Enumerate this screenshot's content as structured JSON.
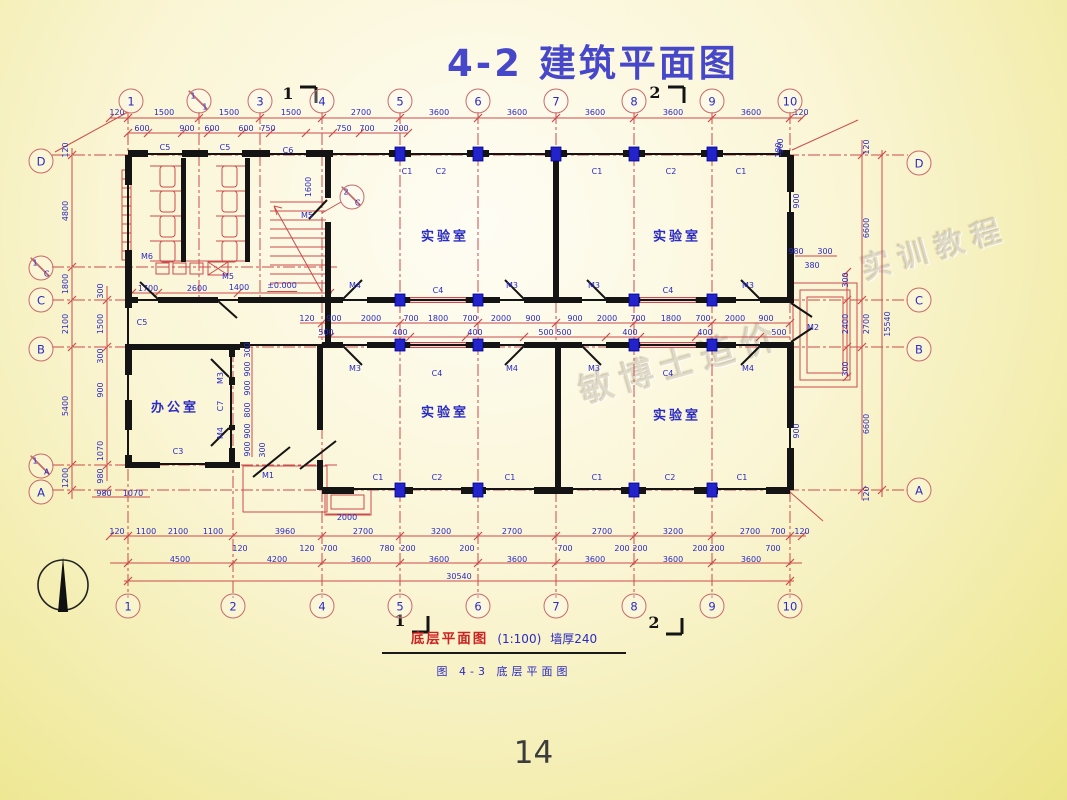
{
  "page": {
    "title": "4-2  建筑平面图",
    "page_number": "14"
  },
  "caption": {
    "name": "底层平面图",
    "scale": "(1:100)",
    "wall_note": "墙厚240",
    "figure": "图 4-3  底层平面图"
  },
  "watermark": {
    "text1": "敏博士造价",
    "text2": "实训教程"
  },
  "colors": {
    "title_blue": "#4747ca",
    "dim_blue": "#2a2ac4",
    "line_red": "#cc4b4b",
    "wall_black": "#141414",
    "column_blue": "#2323cc",
    "caption_red": "#cc2222"
  },
  "plan": {
    "rooms_note": "four labs and one office",
    "bubbles": [
      {
        "t": "1",
        "x": 131,
        "y": 101
      },
      {
        "t": "1/1",
        "x": 199,
        "y": 101
      },
      {
        "t": "3",
        "x": 260,
        "y": 101
      },
      {
        "t": "4",
        "x": 322,
        "y": 101
      },
      {
        "t": "5",
        "x": 400,
        "y": 101
      },
      {
        "t": "6",
        "x": 478,
        "y": 101
      },
      {
        "t": "7",
        "x": 556,
        "y": 101
      },
      {
        "t": "8",
        "x": 634,
        "y": 101
      },
      {
        "t": "9",
        "x": 712,
        "y": 101
      },
      {
        "t": "10",
        "x": 790,
        "y": 101
      },
      {
        "t": "1",
        "x": 128,
        "y": 606
      },
      {
        "t": "2",
        "x": 233,
        "y": 606
      },
      {
        "t": "4",
        "x": 322,
        "y": 606
      },
      {
        "t": "5",
        "x": 400,
        "y": 606
      },
      {
        "t": "6",
        "x": 478,
        "y": 606
      },
      {
        "t": "7",
        "x": 556,
        "y": 606
      },
      {
        "t": "8",
        "x": 634,
        "y": 606
      },
      {
        "t": "9",
        "x": 712,
        "y": 606
      },
      {
        "t": "10",
        "x": 790,
        "y": 606
      },
      {
        "t": "D",
        "x": 41,
        "y": 161
      },
      {
        "t": "1/C",
        "x": 41,
        "y": 268
      },
      {
        "t": "C",
        "x": 41,
        "y": 300
      },
      {
        "t": "B",
        "x": 41,
        "y": 349
      },
      {
        "t": "1/A",
        "x": 41,
        "y": 466
      },
      {
        "t": "A",
        "x": 41,
        "y": 492
      },
      {
        "t": "D",
        "x": 919,
        "y": 163
      },
      {
        "t": "C",
        "x": 919,
        "y": 300
      },
      {
        "t": "B",
        "x": 919,
        "y": 349
      },
      {
        "t": "A",
        "x": 919,
        "y": 490
      },
      {
        "t": "2/C",
        "x": 352,
        "y": 197
      }
    ],
    "labels": [
      {
        "t": "120",
        "x": 117,
        "y": 113
      },
      {
        "t": "1500",
        "x": 164,
        "y": 113
      },
      {
        "t": "1500",
        "x": 229,
        "y": 113
      },
      {
        "t": "1500",
        "x": 291,
        "y": 113
      },
      {
        "t": "2700",
        "x": 361,
        "y": 113
      },
      {
        "t": "3600",
        "x": 439,
        "y": 113
      },
      {
        "t": "3600",
        "x": 517,
        "y": 113
      },
      {
        "t": "3600",
        "x": 595,
        "y": 113
      },
      {
        "t": "3600",
        "x": 673,
        "y": 113
      },
      {
        "t": "3600",
        "x": 751,
        "y": 113
      },
      {
        "t": "120",
        "x": 801,
        "y": 113
      },
      {
        "t": "600",
        "x": 142,
        "y": 129
      },
      {
        "t": "900",
        "x": 187,
        "y": 129
      },
      {
        "t": "600",
        "x": 212,
        "y": 129
      },
      {
        "t": "600",
        "x": 246,
        "y": 129
      },
      {
        "t": "750",
        "x": 268,
        "y": 129
      },
      {
        "t": "750",
        "x": 344,
        "y": 129
      },
      {
        "t": "700",
        "x": 367,
        "y": 129
      },
      {
        "t": "200",
        "x": 401,
        "y": 129
      },
      {
        "t": "900",
        "x": 781,
        "y": 146,
        "r": 1
      },
      {
        "t": "120",
        "x": 66,
        "y": 150,
        "r": 1
      },
      {
        "t": "4800",
        "x": 66,
        "y": 211,
        "r": 1
      },
      {
        "t": "1800",
        "x": 66,
        "y": 284,
        "r": 1
      },
      {
        "t": "2100",
        "x": 66,
        "y": 324,
        "r": 1
      },
      {
        "t": "5400",
        "x": 66,
        "y": 406,
        "r": 1
      },
      {
        "t": "1200",
        "x": 66,
        "y": 478,
        "r": 1
      },
      {
        "t": "300",
        "x": 101,
        "y": 291,
        "r": 1
      },
      {
        "t": "1500",
        "x": 101,
        "y": 324,
        "r": 1
      },
      {
        "t": "300",
        "x": 101,
        "y": 356,
        "r": 1
      },
      {
        "t": "900",
        "x": 101,
        "y": 390,
        "r": 1
      },
      {
        "t": "1070",
        "x": 101,
        "y": 451,
        "r": 1
      },
      {
        "t": "980",
        "x": 101,
        "y": 476,
        "r": 1
      },
      {
        "t": "980",
        "x": 104,
        "y": 494
      },
      {
        "t": "1070",
        "x": 133,
        "y": 494
      },
      {
        "t": "120",
        "x": 867,
        "y": 147,
        "r": 1
      },
      {
        "t": "6600",
        "x": 867,
        "y": 228,
        "r": 1
      },
      {
        "t": "2700",
        "x": 867,
        "y": 324,
        "r": 1
      },
      {
        "t": "6600",
        "x": 867,
        "y": 424,
        "r": 1
      },
      {
        "t": "120",
        "x": 867,
        "y": 494,
        "r": 1
      },
      {
        "t": "15540",
        "x": 888,
        "y": 324,
        "r": 1
      },
      {
        "t": "300",
        "x": 846,
        "y": 280,
        "r": 1
      },
      {
        "t": "2400",
        "x": 846,
        "y": 324,
        "r": 1
      },
      {
        "t": "300",
        "x": 846,
        "y": 369,
        "r": 1
      },
      {
        "t": "900",
        "x": 797,
        "y": 201,
        "r": 1
      },
      {
        "t": "980",
        "x": 796,
        "y": 252
      },
      {
        "t": "300",
        "x": 825,
        "y": 252
      },
      {
        "t": "380",
        "x": 812,
        "y": 266
      },
      {
        "t": "M2",
        "x": 813,
        "y": 328
      },
      {
        "t": "900",
        "x": 797,
        "y": 431,
        "r": 1
      },
      {
        "t": "180",
        "x": 779,
        "y": 150,
        "r": 1
      },
      {
        "t": "C5",
        "x": 165,
        "y": 148
      },
      {
        "t": "C5",
        "x": 225,
        "y": 148
      },
      {
        "t": "C6",
        "x": 288,
        "y": 151
      },
      {
        "t": "1600",
        "x": 309,
        "y": 187,
        "r": 1
      },
      {
        "t": "M5",
        "x": 307,
        "y": 216
      },
      {
        "t": "M5",
        "x": 228,
        "y": 277
      },
      {
        "t": "M6",
        "x": 147,
        "y": 257
      },
      {
        "t": "1700",
        "x": 148,
        "y": 289
      },
      {
        "t": "2600",
        "x": 197,
        "y": 289
      },
      {
        "t": "1400",
        "x": 239,
        "y": 288
      },
      {
        "t": "±0.000",
        "x": 282,
        "y": 287,
        "c": "level"
      },
      {
        "t": "C1",
        "x": 407,
        "y": 172
      },
      {
        "t": "C2",
        "x": 441,
        "y": 172
      },
      {
        "t": "C1",
        "x": 597,
        "y": 172
      },
      {
        "t": "C2",
        "x": 671,
        "y": 172
      },
      {
        "t": "C1",
        "x": 741,
        "y": 172
      },
      {
        "t": "C5",
        "x": 142,
        "y": 323
      },
      {
        "t": "M4",
        "x": 355,
        "y": 286
      },
      {
        "t": "C4",
        "x": 438,
        "y": 291
      },
      {
        "t": "M3",
        "x": 512,
        "y": 286
      },
      {
        "t": "M3",
        "x": 594,
        "y": 286
      },
      {
        "t": "C4",
        "x": 668,
        "y": 291
      },
      {
        "t": "M3",
        "x": 748,
        "y": 286
      },
      {
        "t": "M3",
        "x": 355,
        "y": 369
      },
      {
        "t": "C4",
        "x": 437,
        "y": 374
      },
      {
        "t": "M4",
        "x": 512,
        "y": 369
      },
      {
        "t": "M3",
        "x": 594,
        "y": 369
      },
      {
        "t": "C4",
        "x": 668,
        "y": 374
      },
      {
        "t": "M4",
        "x": 748,
        "y": 369
      },
      {
        "t": "120",
        "x": 307,
        "y": 319
      },
      {
        "t": "900",
        "x": 334,
        "y": 319
      },
      {
        "t": "2000",
        "x": 371,
        "y": 319
      },
      {
        "t": "700",
        "x": 411,
        "y": 319
      },
      {
        "t": "1800",
        "x": 438,
        "y": 319
      },
      {
        "t": "700",
        "x": 470,
        "y": 319
      },
      {
        "t": "2000",
        "x": 501,
        "y": 319
      },
      {
        "t": "900",
        "x": 533,
        "y": 319
      },
      {
        "t": "900",
        "x": 575,
        "y": 319
      },
      {
        "t": "2000",
        "x": 607,
        "y": 319
      },
      {
        "t": "700",
        "x": 638,
        "y": 319
      },
      {
        "t": "1800",
        "x": 671,
        "y": 319
      },
      {
        "t": "700",
        "x": 703,
        "y": 319
      },
      {
        "t": "2000",
        "x": 735,
        "y": 319
      },
      {
        "t": "900",
        "x": 766,
        "y": 319
      },
      {
        "t": "500",
        "x": 326,
        "y": 333
      },
      {
        "t": "400",
        "x": 400,
        "y": 333
      },
      {
        "t": "400",
        "x": 475,
        "y": 333
      },
      {
        "t": "500",
        "x": 546,
        "y": 333
      },
      {
        "t": "500",
        "x": 564,
        "y": 333
      },
      {
        "t": "400",
        "x": 630,
        "y": 333
      },
      {
        "t": "400",
        "x": 705,
        "y": 333
      },
      {
        "t": "500",
        "x": 779,
        "y": 333
      },
      {
        "t": "300",
        "x": 248,
        "y": 350,
        "r": 1
      },
      {
        "t": "900",
        "x": 248,
        "y": 369,
        "r": 1
      },
      {
        "t": "900",
        "x": 248,
        "y": 388,
        "r": 1
      },
      {
        "t": "800",
        "x": 248,
        "y": 410,
        "r": 1
      },
      {
        "t": "900",
        "x": 248,
        "y": 431,
        "r": 1
      },
      {
        "t": "900",
        "x": 248,
        "y": 449,
        "r": 1
      },
      {
        "t": "300",
        "x": 263,
        "y": 450,
        "r": 1
      },
      {
        "t": "M3",
        "x": 221,
        "y": 378,
        "r": 1
      },
      {
        "t": "C7",
        "x": 221,
        "y": 406,
        "r": 1
      },
      {
        "t": "M4",
        "x": 221,
        "y": 433,
        "r": 1
      },
      {
        "t": "C3",
        "x": 178,
        "y": 452
      },
      {
        "t": "M1",
        "x": 268,
        "y": 476
      },
      {
        "t": "2000",
        "x": 347,
        "y": 518
      },
      {
        "t": "C1",
        "x": 378,
        "y": 478
      },
      {
        "t": "C2",
        "x": 437,
        "y": 478
      },
      {
        "t": "C1",
        "x": 510,
        "y": 478
      },
      {
        "t": "C1",
        "x": 597,
        "y": 478
      },
      {
        "t": "C2",
        "x": 670,
        "y": 478
      },
      {
        "t": "C1",
        "x": 742,
        "y": 478
      },
      {
        "t": "120",
        "x": 117,
        "y": 532
      },
      {
        "t": "1100",
        "x": 146,
        "y": 532
      },
      {
        "t": "2100",
        "x": 178,
        "y": 532
      },
      {
        "t": "1100",
        "x": 213,
        "y": 532
      },
      {
        "t": "3960",
        "x": 285,
        "y": 532
      },
      {
        "t": "2700",
        "x": 363,
        "y": 532
      },
      {
        "t": "3200",
        "x": 441,
        "y": 532
      },
      {
        "t": "2700",
        "x": 512,
        "y": 532
      },
      {
        "t": "2700",
        "x": 602,
        "y": 532
      },
      {
        "t": "3200",
        "x": 673,
        "y": 532
      },
      {
        "t": "2700",
        "x": 750,
        "y": 532
      },
      {
        "t": "700",
        "x": 778,
        "y": 532
      },
      {
        "t": "120",
        "x": 802,
        "y": 532
      },
      {
        "t": "120",
        "x": 240,
        "y": 549
      },
      {
        "t": "120",
        "x": 307,
        "y": 549
      },
      {
        "t": "700",
        "x": 330,
        "y": 549
      },
      {
        "t": "780",
        "x": 387,
        "y": 549
      },
      {
        "t": "200",
        "x": 408,
        "y": 549
      },
      {
        "t": "200",
        "x": 467,
        "y": 549
      },
      {
        "t": "700",
        "x": 565,
        "y": 549
      },
      {
        "t": "200",
        "x": 622,
        "y": 549
      },
      {
        "t": "200",
        "x": 640,
        "y": 549
      },
      {
        "t": "200",
        "x": 700,
        "y": 549
      },
      {
        "t": "200",
        "x": 717,
        "y": 549
      },
      {
        "t": "700",
        "x": 773,
        "y": 549
      },
      {
        "t": "4500",
        "x": 180,
        "y": 560
      },
      {
        "t": "4200",
        "x": 277,
        "y": 560
      },
      {
        "t": "3600",
        "x": 361,
        "y": 560
      },
      {
        "t": "3600",
        "x": 439,
        "y": 560
      },
      {
        "t": "3600",
        "x": 517,
        "y": 560
      },
      {
        "t": "3600",
        "x": 595,
        "y": 560
      },
      {
        "t": "3600",
        "x": 673,
        "y": 560
      },
      {
        "t": "3600",
        "x": 751,
        "y": 560
      },
      {
        "t": "30540",
        "x": 459,
        "y": 577
      },
      {
        "t": "实验室",
        "x": 445,
        "y": 237,
        "c": "room"
      },
      {
        "t": "实验室",
        "x": 677,
        "y": 237,
        "c": "room"
      },
      {
        "t": "实验室",
        "x": 445,
        "y": 413,
        "c": "room"
      },
      {
        "t": "实验室",
        "x": 677,
        "y": 416,
        "c": "room"
      },
      {
        "t": "办公室",
        "x": 175,
        "y": 408,
        "c": "room"
      },
      {
        "t": "1",
        "x": 288,
        "y": 94,
        "c": "sec"
      },
      {
        "t": "2",
        "x": 655,
        "y": 93,
        "c": "sec"
      },
      {
        "t": "1",
        "x": 400,
        "y": 621,
        "c": "sec"
      },
      {
        "t": "2",
        "x": 654,
        "y": 623,
        "c": "sec"
      }
    ]
  }
}
